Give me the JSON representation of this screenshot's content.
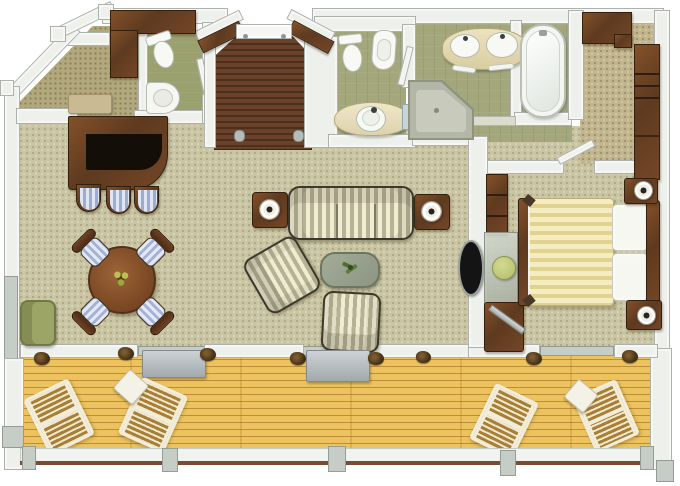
{
  "canvas": {
    "width": 680,
    "height": 486
  },
  "diagram_type": "suite-floor-plan-top-view",
  "palette": {
    "background": "#ffffff",
    "wall": "#eef0ec",
    "wall_edge": "#adb3ac",
    "wall_gray": "#c6ccc6",
    "wood_dark": "#5e3a20",
    "wood_mid": "#835129",
    "carpet_beige": "#c9c4a3",
    "carpet_tan": "#c0b58e",
    "carpet_hall": "#b2a87e",
    "floor_olive": "#a3a77b",
    "deck_gold": "#ecc35e",
    "deck_line": "#99611a",
    "rail_brown": "#7a4a33",
    "sofa_cream": "#f0ebd2",
    "sofa_sage": "#b6b294",
    "bed_cream": "#f4edc2",
    "bed_gold": "#e2d28f",
    "cushion_blue": "#9dadd0",
    "fixture_white": "#f8f9f5",
    "glass_gray": "#ccd2d5",
    "stool_green": "#b2bc6a",
    "plant_brown": "#4a3318",
    "coffee_table_green": "#9aa38f",
    "tv_black": "#141414"
  },
  "rooms": [
    {
      "name": "entry-foyer"
    },
    {
      "name": "entry-hall"
    },
    {
      "name": "powder-room"
    },
    {
      "name": "toilet-room"
    },
    {
      "name": "master-bathroom"
    },
    {
      "name": "dressing-area"
    },
    {
      "name": "bedroom"
    },
    {
      "name": "living-room"
    },
    {
      "name": "dining-area"
    },
    {
      "name": "bar-area"
    },
    {
      "name": "balcony"
    }
  ],
  "furniture": {
    "entry": [
      "entry-door",
      "wood-floor",
      "wardrobe",
      "bench"
    ],
    "powder_room": [
      "toilet",
      "corner-sink",
      "door"
    ],
    "toilet_room": [
      "toilet",
      "bidet",
      "round-basin",
      "glass-shelf",
      "door"
    ],
    "master_bathroom": [
      "double-sink-vanity",
      "bathtub",
      "corner-shower",
      "towel-rails"
    ],
    "dressing_area": [
      "wardrobe-top",
      "wardrobe-tall",
      "door"
    ],
    "bar_area": [
      "bar-counter",
      "bar-stool",
      "bar-stool",
      "bar-stool"
    ],
    "dining_area": [
      "round-table",
      "centerpiece",
      "chair-ne",
      "chair-nw",
      "chair-se",
      "chair-sw"
    ],
    "living_room": [
      "sofa",
      "side-table-left",
      "side-table-right",
      "table-lamp",
      "table-lamp",
      "armchair",
      "armchair-2",
      "coffee-table",
      "plant",
      "tv",
      "olive-chair"
    ],
    "bedroom": [
      "bed",
      "duvet",
      "pillows",
      "headboard",
      "footboard",
      "nightstand",
      "nightstand",
      "lamp",
      "lamp",
      "shelving",
      "vanity-desk",
      "green-stool",
      "corner-tv-desk"
    ],
    "balcony": [
      "deck",
      "lounger",
      "lounger",
      "lounger",
      "lounger",
      "side-table",
      "side-table",
      "storage-box",
      "storage-box",
      "railing",
      "potted-plants"
    ]
  }
}
